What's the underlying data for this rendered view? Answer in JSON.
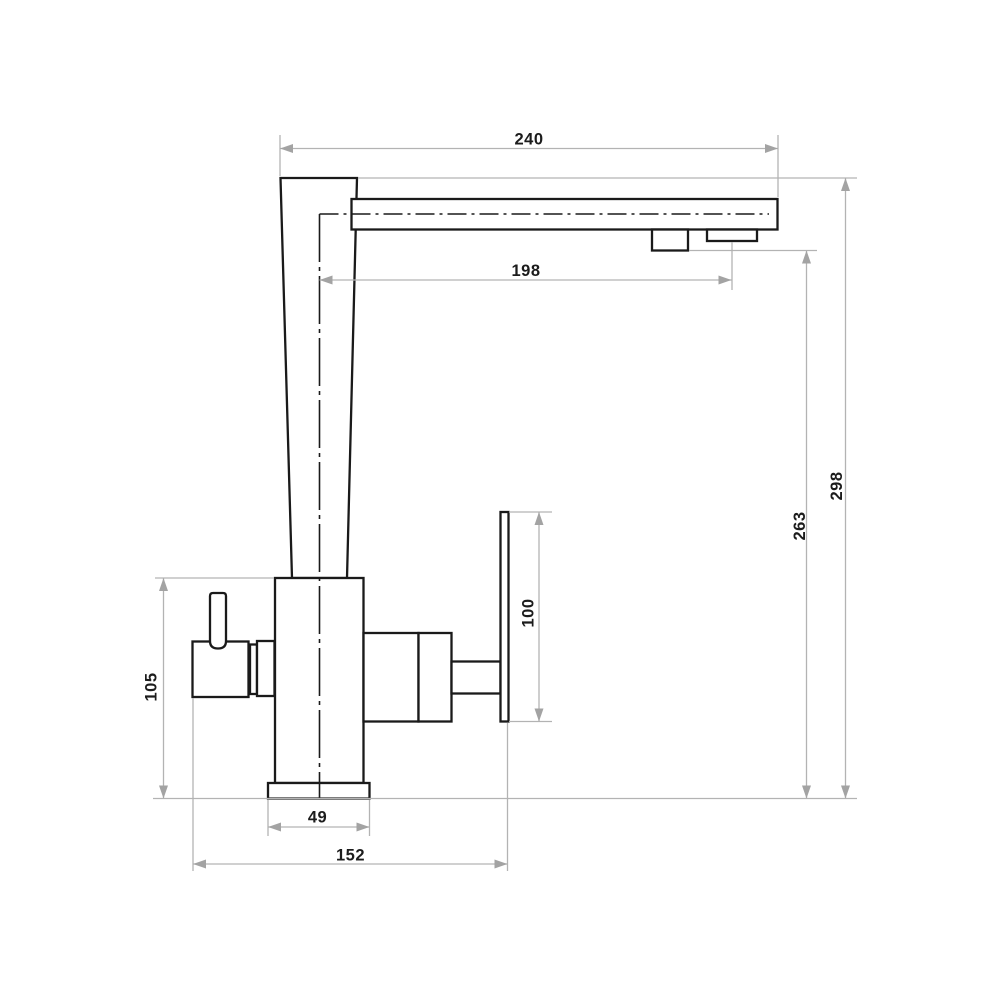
{
  "drawing": {
    "dimensions": {
      "spout_reach": "240",
      "spout_projection": "198",
      "total_height": "298",
      "outlet_height": "263",
      "handle_plate_length": "100",
      "body_height": "105",
      "base_width": "49",
      "overall_depth": "152"
    },
    "colors": {
      "background": "#ffffff",
      "outline": "#1a1a1a",
      "centerline": "#1a1a1a",
      "dimension_line": "#b3b3b3",
      "arrow": "#a3a3a3",
      "label_text": "#1c1c1c"
    }
  }
}
